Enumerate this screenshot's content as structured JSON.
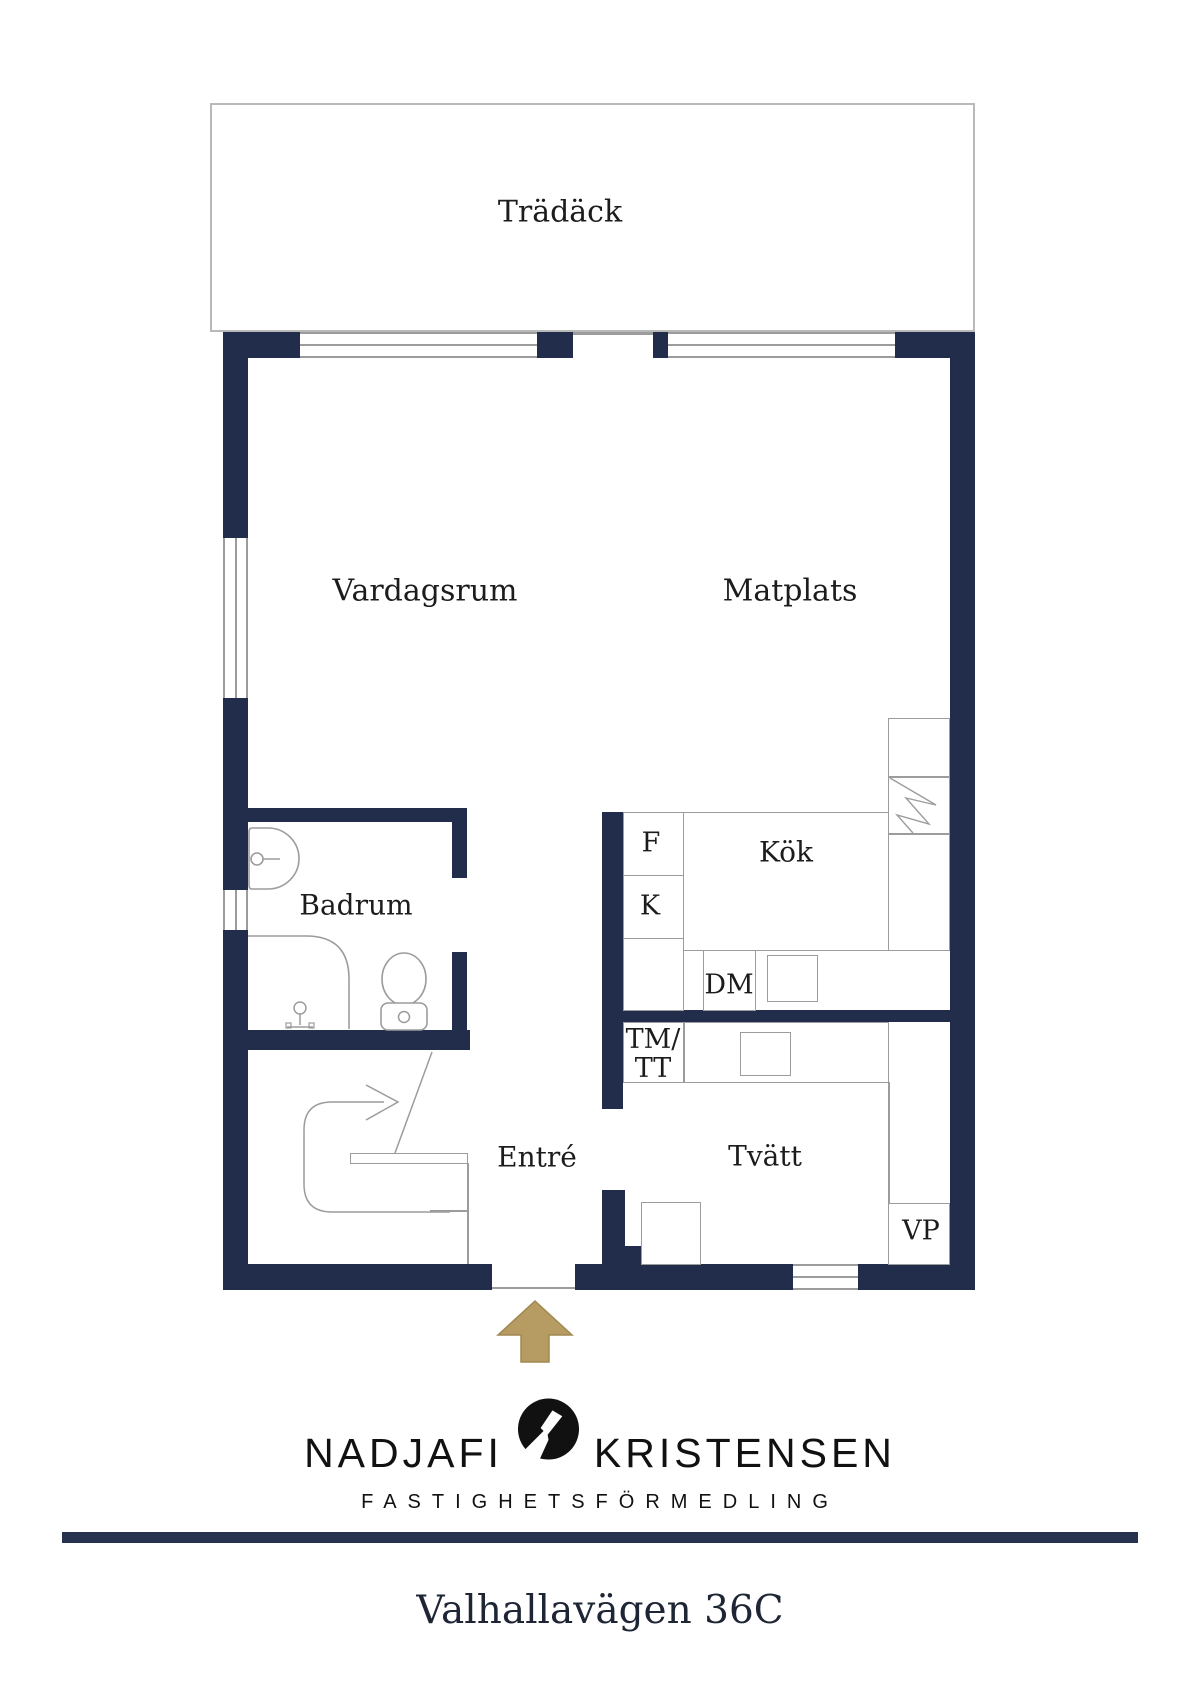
{
  "floor_plan": {
    "deck_label": "Trädäck",
    "living_room_label": "Vardagsrum",
    "dining_label": "Matplats",
    "bathroom_label": "Badrum",
    "kitchen_label": "Kök",
    "entry_label": "Entré",
    "laundry_label": "Tvätt",
    "fridge_label": "F",
    "freezer_label": "K",
    "dishwasher_label": "DM",
    "washer_label": "TM/",
    "dryer_label": "TT",
    "heat_pump_label": "VP"
  },
  "branding": {
    "name_left": "NADJAFI",
    "name_right": "KRISTENSEN",
    "tagline": "FASTIGHETSFÖRMEDLING"
  },
  "footer": {
    "address": "Valhallavägen 36C"
  },
  "colors": {
    "wall": "#212d4a",
    "fixture_line": "#9c9c9c",
    "entry_arrow": "#b69c62"
  }
}
